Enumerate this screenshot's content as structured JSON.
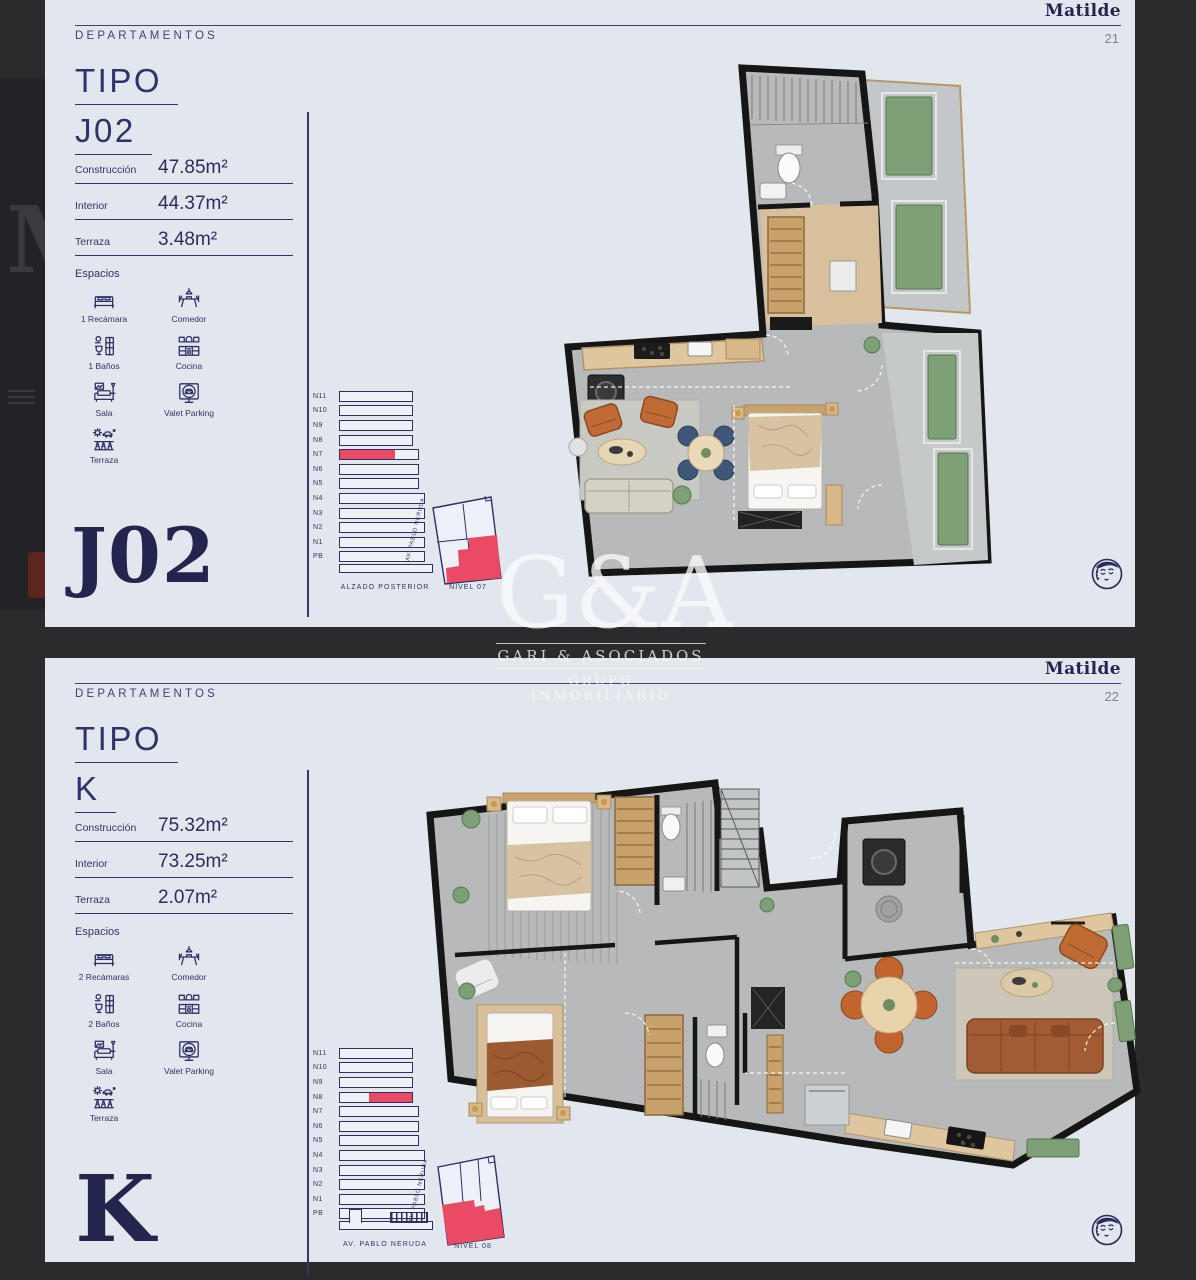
{
  "brand": {
    "name": "Matilde",
    "monogram": "G&A",
    "firm": "GARI & ASOCIADOS",
    "tagline": "GRUPO INMOBILIARIO",
    "behind_letter": "M"
  },
  "colors": {
    "page_bg": "#e2e7ee",
    "navy": "#2f3166",
    "accent_red": "#ea4a63",
    "viewer_bg": "#2b2b2e"
  },
  "pages": [
    {
      "header": {
        "section": "DEPARTAMENTOS",
        "brand": "Matilde",
        "page_number": "21"
      },
      "tipo": {
        "line1": "TIPO",
        "line2": "J02"
      },
      "big_label": "J02",
      "metrics": [
        {
          "label": "Construcción",
          "value": "47.85m²"
        },
        {
          "label": "Interior",
          "value": "44.37m²"
        },
        {
          "label": "Terraza",
          "value": "3.48m²"
        }
      ],
      "espacios": {
        "title": "Espacios",
        "items": [
          {
            "icon": "bed-icon",
            "label": "1 Recámara"
          },
          {
            "icon": "dining-icon",
            "label": "Comedor"
          },
          {
            "icon": "bath-icon",
            "label": "1 Baños"
          },
          {
            "icon": "kitchen-icon",
            "label": "Cocina"
          },
          {
            "icon": "sofa-icon",
            "label": "Sala"
          },
          {
            "icon": "valet-parking-icon",
            "label": "Valet Parking"
          },
          {
            "icon": "terrace-icon",
            "label": "Terraza"
          }
        ]
      },
      "elevation": {
        "floors": [
          "N11",
          "N10",
          "N9",
          "N8",
          "N7",
          "N6",
          "N5",
          "N4",
          "N3",
          "N2",
          "N1",
          "PB"
        ],
        "highlighted_floor": "N7",
        "caption": "ALZADO POSTERIOR"
      },
      "site_plan": {
        "street": "AV. PABLO NERUDA",
        "caption": "NIVEL 07"
      }
    },
    {
      "header": {
        "section": "DEPARTAMENTOS",
        "brand": "Matilde",
        "page_number": "22"
      },
      "tipo": {
        "line1": "TIPO",
        "line2": "K"
      },
      "big_label": "K",
      "metrics": [
        {
          "label": "Construcción",
          "value": "75.32m²"
        },
        {
          "label": "Interior",
          "value": "73.25m²"
        },
        {
          "label": "Terraza",
          "value": "2.07m²"
        }
      ],
      "espacios": {
        "title": "Espacios",
        "items": [
          {
            "icon": "bed-icon",
            "label": "2 Recámaras"
          },
          {
            "icon": "dining-icon",
            "label": "Comedor"
          },
          {
            "icon": "bath-icon",
            "label": "2 Baños"
          },
          {
            "icon": "kitchen-icon",
            "label": "Cocina"
          },
          {
            "icon": "sofa-icon",
            "label": "Sala"
          },
          {
            "icon": "valet-parking-icon",
            "label": "Valet Parking"
          },
          {
            "icon": "terrace-icon",
            "label": "Terraza"
          }
        ]
      },
      "elevation": {
        "floors": [
          "N11",
          "N10",
          "N9",
          "N8",
          "N7",
          "N6",
          "N5",
          "N4",
          "N3",
          "N2",
          "N1",
          "PB"
        ],
        "highlighted_floor": "N8",
        "caption": "AV. PABLO NERUDA"
      },
      "site_plan": {
        "street": "AV. PABLO NERUDA",
        "caption": "NIVEL 08"
      }
    }
  ]
}
